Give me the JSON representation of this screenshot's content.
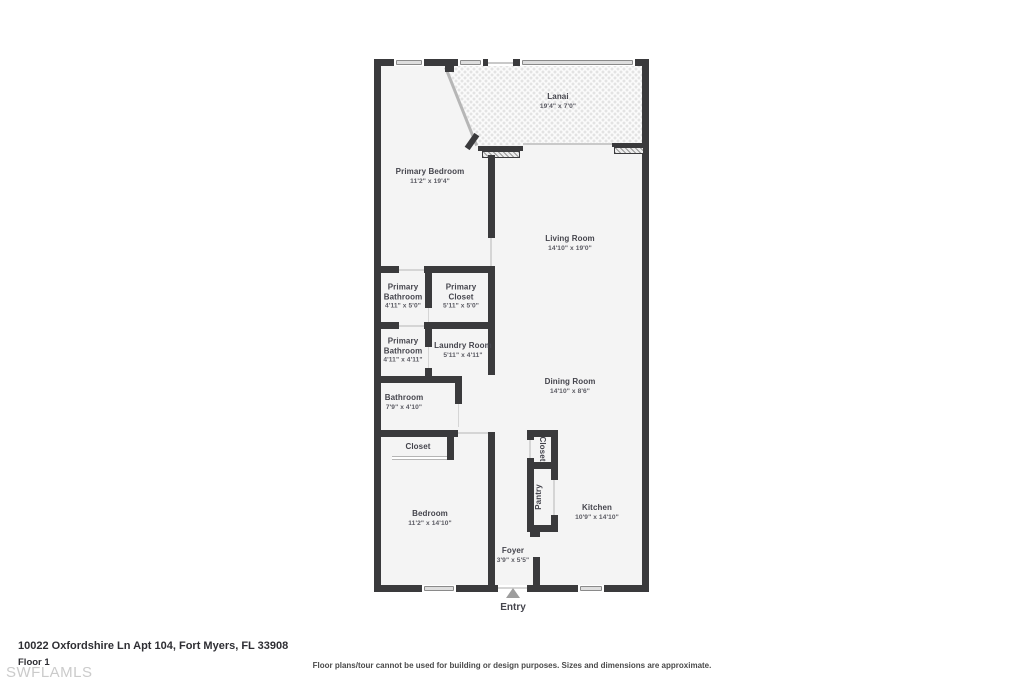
{
  "page": {
    "address": "10022 Oxfordshire Ln Apt 104, Fort Myers, FL 33908",
    "floor_label": "Floor 1",
    "watermark": "SWFLAMLS",
    "disclaimer": "Floor plans/tour cannot be used for building or design purposes. Sizes and dimensions are approximate.",
    "entry_label": "Entry"
  },
  "colors": {
    "wall": "#3a3a3c",
    "room_fill": "#f4f4f4",
    "window_fill": "#dedede",
    "label_text": "#45454d",
    "dim_text": "#5b5b63",
    "door_line": "#d5d5d5",
    "screen_line": "#c9c9c9",
    "entry_arrow": "#9d9d9d",
    "watermark_text": "#cbcbcb",
    "disclaimer_text": "#4a4a4a"
  },
  "rooms": {
    "lanai": {
      "name": "Lanai",
      "dims": "19'4\" x 7'0\""
    },
    "primary_bedroom": {
      "name": "Primary Bedroom",
      "dims": "11'2\" x 19'4\""
    },
    "living_room": {
      "name": "Living Room",
      "dims": "14'10\" x 19'0\""
    },
    "primary_bathroom_1": {
      "name": "Primary Bathroom",
      "dims": "4'11\" x 5'0\""
    },
    "primary_closet": {
      "name": "Primary Closet",
      "dims": "5'11\" x 5'0\""
    },
    "primary_bathroom_2": {
      "name": "Primary Bathroom",
      "dims": "4'11\" x 4'11\""
    },
    "laundry_room": {
      "name": "Laundry Room",
      "dims": "5'11\" x 4'11\""
    },
    "bathroom": {
      "name": "Bathroom",
      "dims": "7'9\" x 4'10\""
    },
    "dining_room": {
      "name": "Dining Room",
      "dims": "14'10\" x 8'6\""
    },
    "closet_hall": {
      "name": "Closet"
    },
    "closet_reach": {
      "name": "Closet"
    },
    "pantry": {
      "name": "Pantry"
    },
    "bedroom": {
      "name": "Bedroom",
      "dims": "11'2\" x 14'10\""
    },
    "kitchen": {
      "name": "Kitchen",
      "dims": "10'9\" x 14'10\""
    },
    "foyer": {
      "name": "Foyer",
      "dims": "3'9\" x 5'5\""
    }
  }
}
